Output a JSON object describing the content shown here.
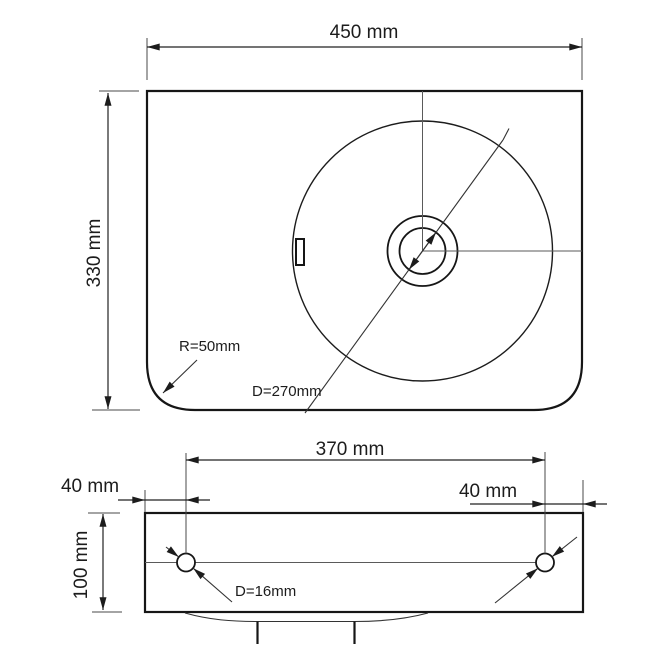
{
  "meta": {
    "background_color": "#ffffff",
    "line_color": "#1c1c1c",
    "drawing_type": "washbasin dimensional drawing"
  },
  "top_view": {
    "width_label": "450 mm",
    "depth_label": "330 mm",
    "corner_radius_label": "R=50mm",
    "bowl_diameter_label": "D=270mm"
  },
  "front_view": {
    "hole_spacing_label": "370 mm",
    "left_edge_offset_label": "40 mm",
    "right_edge_offset_label": "40 mm",
    "height_label": "100 mm",
    "hole_diameter_label": "D=16mm"
  }
}
